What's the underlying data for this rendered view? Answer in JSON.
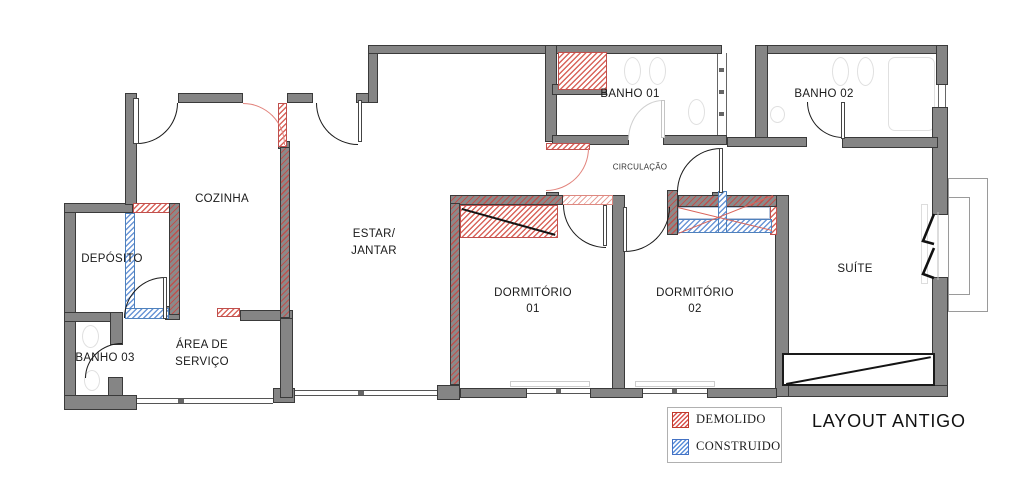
{
  "title": "LAYOUT ANTIGO",
  "rooms": {
    "cozinha": {
      "label": "COZINHA"
    },
    "deposito": {
      "label": "DEPÓSITO"
    },
    "banho03": {
      "label": "BANHO 03"
    },
    "area_servico": {
      "line1": "ÁREA DE",
      "line2": "SERVIÇO"
    },
    "estar_jantar": {
      "line1": "ESTAR/",
      "line2": "JANTAR"
    },
    "banho01": {
      "label": "BANHO 01"
    },
    "banho02": {
      "label": "BANHO 02"
    },
    "circulacao": {
      "label": "CIRCULAÇÃO"
    },
    "dormitorio01": {
      "line1": "DORMITÓRIO",
      "line2": "01"
    },
    "dormitorio02": {
      "line1": "DORMITÓRIO",
      "line2": "02"
    },
    "suite": {
      "label": "SUÍTE"
    }
  },
  "legend": {
    "demolido": "DEMOLIDO",
    "construido": "CONSTRUIDO"
  },
  "colors": {
    "wall_gray": "#858585",
    "wall_edge": "#3a3a3a",
    "demolido_red": "#d9534f",
    "construido_blue": "#5b8fd9"
  }
}
